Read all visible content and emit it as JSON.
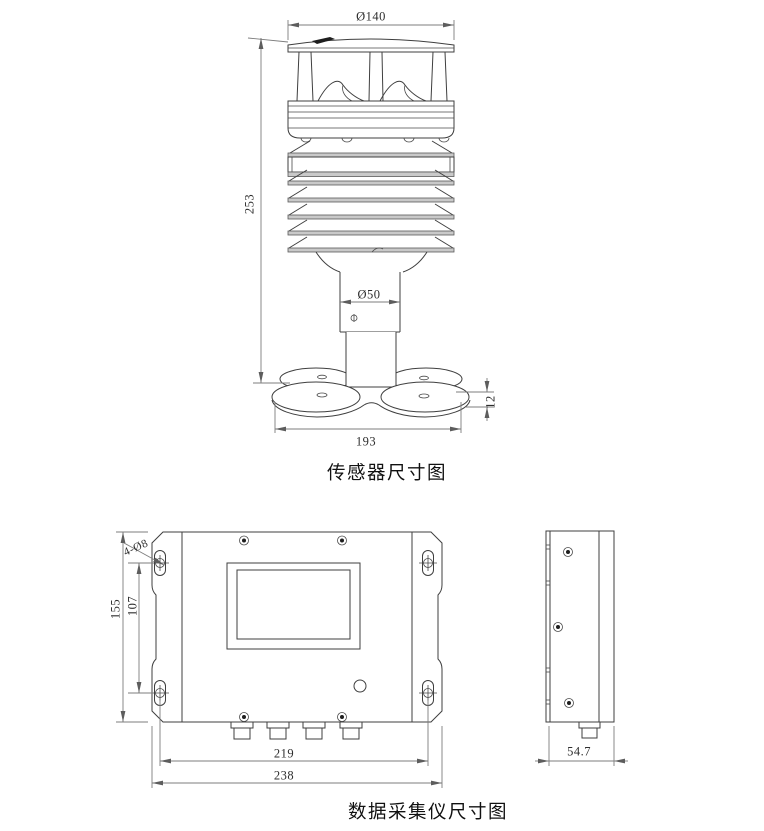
{
  "page": {
    "background": "#ffffff"
  },
  "style": {
    "line_color": "#3f3f3f",
    "dimension_color": "#7d7d7d",
    "louver_fill": "#c9c9c9"
  },
  "sensor_figure": {
    "caption": "传感器尺寸图",
    "dimensions": {
      "cap_diameter": "Ø140",
      "overall_height": "253",
      "pole_diameter": "Ø50",
      "base_thickness": "12",
      "base_width": "193"
    }
  },
  "collector_figure": {
    "caption": "数据采集仪尺寸图",
    "dimensions": {
      "mount_hole_callout": "4-Ø8",
      "overall_height": "155",
      "mount_hole_vertical_spacing": "107",
      "mount_hole_horizontal_spacing": "219",
      "overall_width": "238",
      "depth": "54.7"
    }
  }
}
